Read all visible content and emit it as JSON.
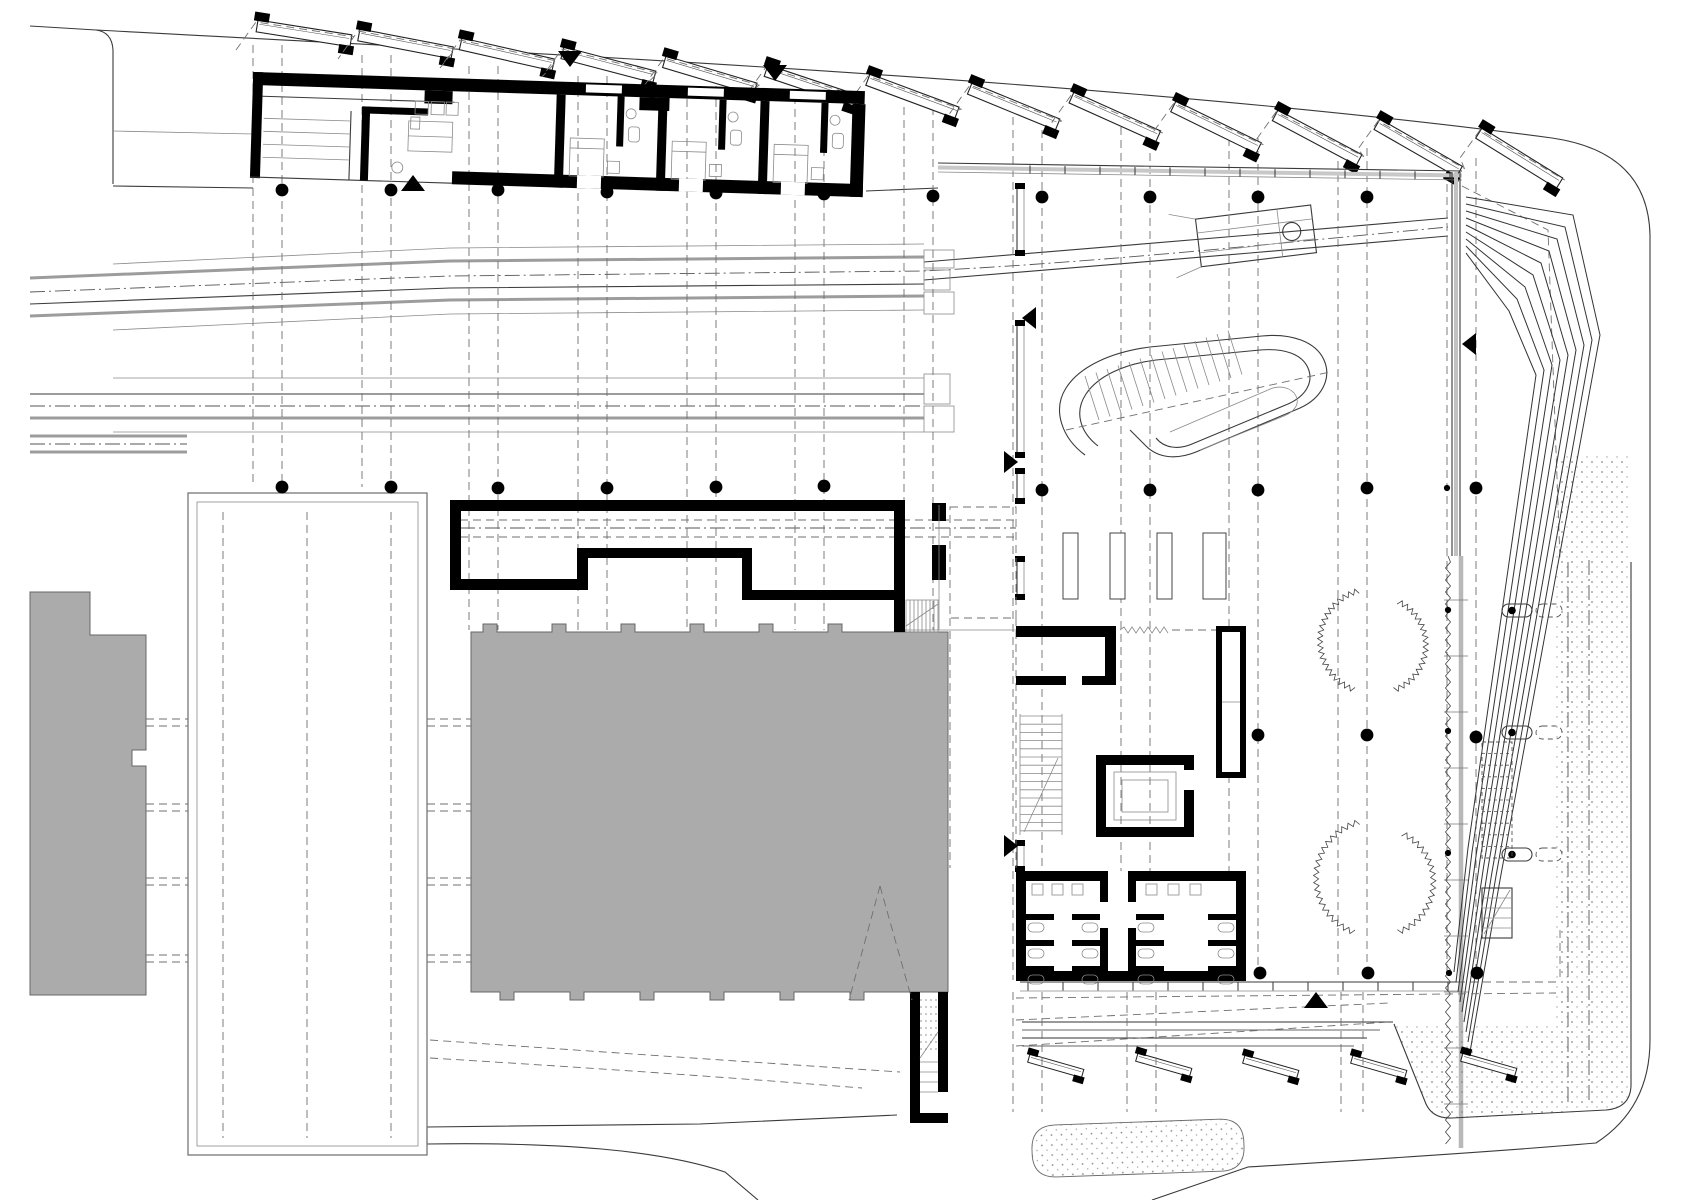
{
  "document": {
    "type": "architectural-plan",
    "view": "ground-floor-site-plan",
    "language": "none-visible-text"
  },
  "colors": {
    "background": "#ffffff",
    "line_dark": "#1c1c1c",
    "line_mid": "#555555",
    "line_light": "#9c9c9c",
    "wall_fill": "#000000",
    "existing_building_fill": "#ababab",
    "existing_building_stroke": "#676767",
    "stipple_dot": "#8a8a8a",
    "facade_gray": "#bdbdbd"
  },
  "plan": {
    "column_grid": {
      "dot_radius": 6.4,
      "small_dot_radius": 3.1,
      "dots_large": [
        [
          282,
          190
        ],
        [
          391,
          190
        ],
        [
          498,
          190
        ],
        [
          607,
          192
        ],
        [
          716,
          193
        ],
        [
          824,
          194
        ],
        [
          933,
          196
        ],
        [
          1042,
          197
        ],
        [
          1150,
          197
        ],
        [
          1258,
          197
        ],
        [
          1367,
          197
        ],
        [
          282,
          487
        ],
        [
          391,
          487
        ],
        [
          498,
          488
        ],
        [
          607,
          488
        ],
        [
          716,
          487
        ],
        [
          824,
          486
        ],
        [
          1042,
          490
        ],
        [
          1150,
          490
        ],
        [
          1258,
          490
        ],
        [
          1367,
          488
        ],
        [
          1476,
          488
        ],
        [
          1258,
          735
        ],
        [
          1367,
          735
        ],
        [
          1476,
          737
        ],
        [
          1260,
          973
        ],
        [
          1368,
          973
        ],
        [
          1477,
          973
        ]
      ],
      "dots_small": [
        [
          1447,
          488
        ],
        [
          1449,
          973
        ],
        [
          1448,
          610
        ],
        [
          1448,
          731
        ],
        [
          1448,
          853
        ]
      ],
      "gridline_pairs": [
        [
          253,
          282
        ],
        [
          362,
          391
        ],
        [
          469,
          498
        ],
        [
          578,
          607
        ],
        [
          687,
          716
        ],
        [
          795,
          824
        ],
        [
          904,
          933
        ],
        [
          1013,
          1042
        ],
        [
          1121,
          1150
        ],
        [
          1229,
          1258
        ],
        [
          1338,
          1367
        ],
        [
          1447,
          1476
        ]
      ]
    },
    "roof_monitors": {
      "count": 13,
      "start_x": 258,
      "spacing": 102,
      "start_y": 20,
      "y_step": 9,
      "base_angle": 9,
      "angle_step": 1.9,
      "length": 95,
      "width": 12
    },
    "skylights_south": {
      "angle": 16,
      "length": 56,
      "width": 8.5,
      "positions": [
        [
          1030,
          1054
        ],
        [
          1138,
          1053
        ],
        [
          1245,
          1055
        ],
        [
          1353,
          1055
        ],
        [
          1463,
          1053
        ]
      ]
    },
    "down_arrows": [
      [
        570,
        58
      ],
      [
        775,
        72
      ]
    ],
    "up_arrows": [
      [
        413,
        184
      ],
      [
        1316,
        1001
      ]
    ],
    "side_arrows": [
      {
        "x": 1036,
        "y": 318,
        "dir": "left"
      },
      {
        "x": 1004,
        "y": 462,
        "dir": "right"
      },
      {
        "x": 1004,
        "y": 846,
        "dir": "right"
      },
      {
        "x": 1476,
        "y": 344,
        "dir": "left"
      }
    ],
    "cascade_steps": 9,
    "south_roof_lines": [
      [
        1022,
        1393
      ],
      [
        1030,
        1380
      ],
      [
        1038,
        1367
      ],
      [
        1046,
        1354
      ]
    ],
    "trees": [
      {
        "cx": 1372,
        "cy": 641,
        "r": 52
      },
      {
        "cx": 1374,
        "cy": 878,
        "r": 58
      }
    ],
    "light_wells": [
      [
        1063,
        533,
        15,
        66
      ],
      [
        1110,
        533,
        15,
        66
      ],
      [
        1157,
        533,
        15,
        66
      ],
      [
        1203,
        533,
        23,
        66
      ]
    ],
    "wall_pills_y": [
      604,
      726,
      848
    ],
    "facade_ticks": {
      "north": {
        "x1": 1030,
        "x2": 1450,
        "step": 35
      },
      "south": {
        "x1": 1028,
        "x2": 1450,
        "step": 35
      }
    },
    "toilet_rooms": [
      [
        1026,
        1100
      ],
      [
        1136,
        1236
      ]
    ],
    "toilet_divider_y": [
      914,
      940,
      966
    ],
    "toilet_square_rows": [
      [
        1032,
        1052,
        1072
      ],
      [
        1146,
        1168,
        1190
      ]
    ],
    "canopy_dash_x": [
      223,
      307,
      391
    ],
    "projection_dash_x_below_hall": [
      1013,
      1042,
      1127,
      1156,
      1341,
      1363
    ],
    "canopy_side_dash_y": [
      [
        719,
        726
      ],
      [
        804,
        811
      ],
      [
        878,
        885
      ],
      [
        955,
        962
      ]
    ]
  },
  "elements": [
    "site-boundary",
    "railway-tracks",
    "column-grid",
    "roof-monitor-row",
    "guest-rooms-building",
    "platform-canopy",
    "existing-building-left",
    "existing-building-main",
    "underpass-corridor",
    "exhibition-hall",
    "ramp-sculpture",
    "service-core",
    "toilets",
    "east-cascade-steps",
    "stippled-terrace",
    "pond",
    "trees",
    "plaza-stair",
    "conveyor-gantry"
  ]
}
